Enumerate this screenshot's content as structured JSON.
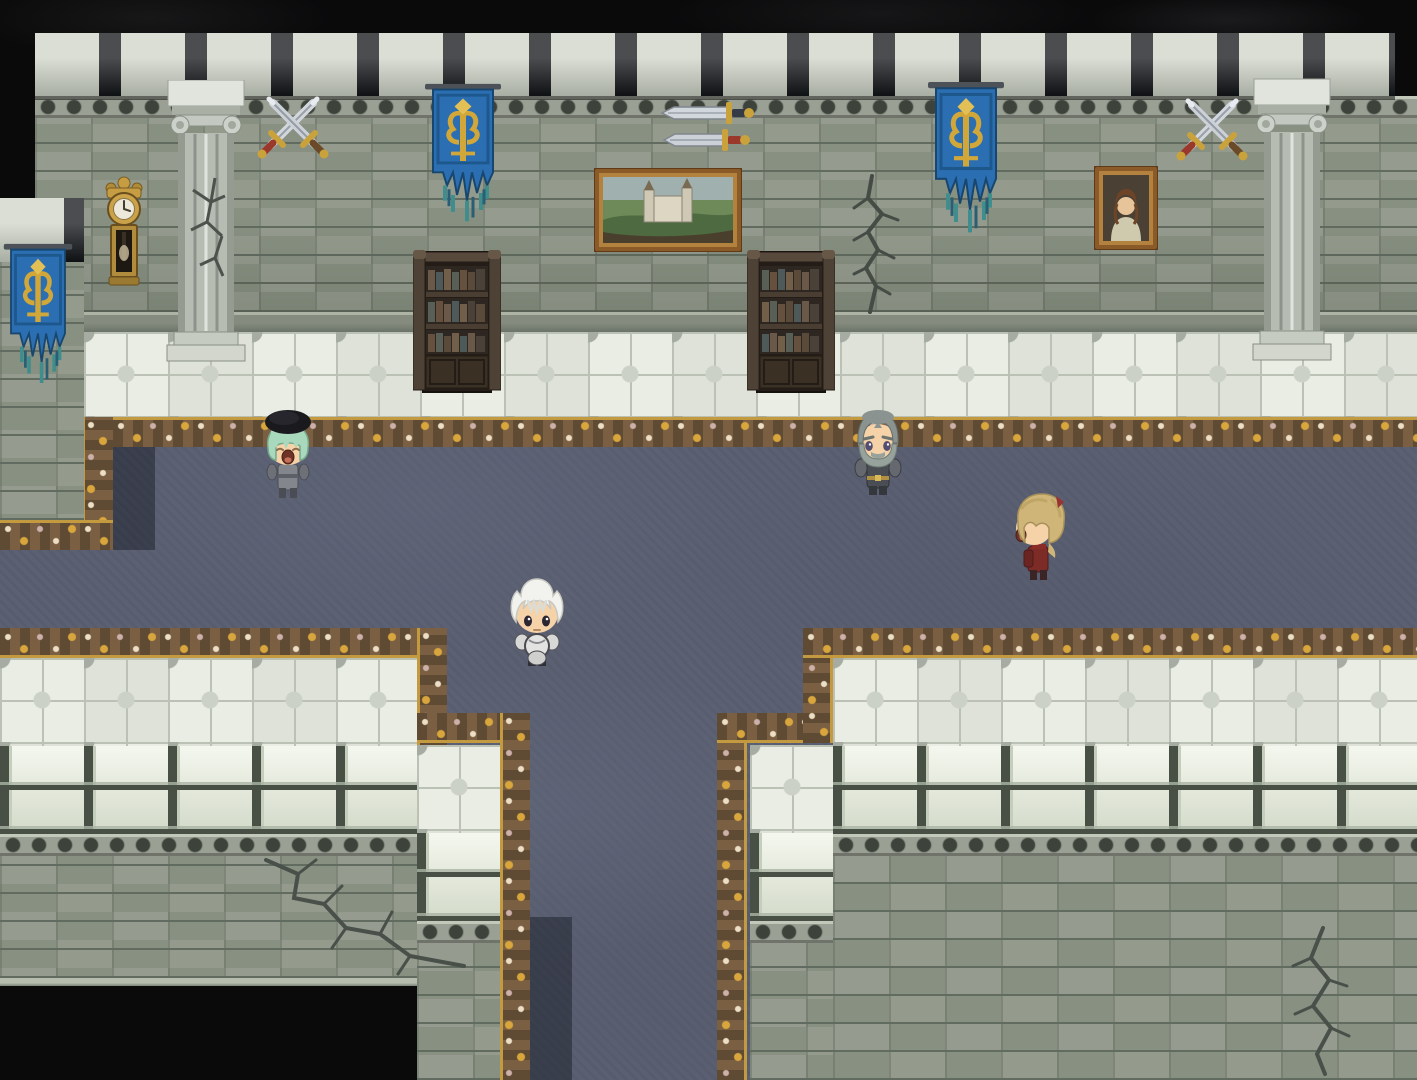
{
  "scene": {
    "title": "Castle Great Hall",
    "type": "rpg-top-down-map",
    "engine_style": "RPG Maker style pixel-art interior",
    "description": "Stone castle hall with battlemented walls, ionic columns, heraldic banners, mounted swords, paintings, a grandfather clock and bookshelves. A dark blue carpeted corridor with ornate gold borders runs horizontally and branches south between two lower wall blocks. Four chibi characters stand in the hall.",
    "visible_text": "none"
  },
  "palette": {
    "void": "#0a0a0b",
    "wall_brick": "#8e948a",
    "wall_mortar": "#626b60",
    "merlon_light": "#ced4c7",
    "cap_block": "#d8dfd0",
    "cap_gap": "#485046",
    "tile_floor": "#e4e7de",
    "tile_accent": "#a6aca2",
    "carpet": "#5b6173",
    "border_base": "#4a4134",
    "border_gold": "#d8a63c",
    "border_cream": "#ecdfc6",
    "banner_blue": "#2b6fb2",
    "banner_gold": "#d2a739",
    "banner_fringe_teal": "#3f8d8d",
    "wood_dark": "#3a3024",
    "clock_gold": "#c69d42",
    "sword_steel": "#d2d7dd",
    "sword_guard_gold": "#caa23c",
    "sword_grip_red": "#9a382c",
    "frame_brown": "#8a5a28"
  },
  "decorations": [
    {
      "id": "grandfather-clock",
      "label": "Gold grandfather wall clock",
      "pos": {
        "x": 97,
        "y": 175,
        "w": 54,
        "h": 118
      }
    },
    {
      "id": "column-cracked",
      "label": "Cracked ionic column",
      "pos": {
        "x": 165,
        "y": 80,
        "w": 82,
        "h": 287
      }
    },
    {
      "id": "column-intact",
      "label": "Ionic column",
      "pos": {
        "x": 1251,
        "y": 78,
        "w": 82,
        "h": 289
      }
    },
    {
      "id": "crossed-swords-left",
      "label": "Crossed swords wall mount",
      "pos": {
        "x": 255,
        "y": 93,
        "w": 76,
        "h": 70
      }
    },
    {
      "id": "crossed-swords-right",
      "label": "Crossed swords wall mount",
      "pos": {
        "x": 1174,
        "y": 95,
        "w": 76,
        "h": 70
      }
    },
    {
      "id": "mounted-swords-pair",
      "label": "Two horizontal display swords",
      "pos": {
        "x": 658,
        "y": 98,
        "w": 100,
        "h": 58
      }
    },
    {
      "id": "banner-buttress",
      "label": "Blue heraldic banner on buttress",
      "pos": {
        "x": 2,
        "y": 242,
        "w": 72,
        "h": 162
      }
    },
    {
      "id": "banner-left",
      "label": "Blue heraldic banner",
      "pos": {
        "x": 423,
        "y": 82,
        "w": 80,
        "h": 160
      }
    },
    {
      "id": "banner-right",
      "label": "Blue heraldic banner",
      "pos": {
        "x": 926,
        "y": 80,
        "w": 80,
        "h": 175
      }
    },
    {
      "id": "painting-landscape",
      "label": "Framed landscape painting of a castle",
      "pos": {
        "x": 594,
        "y": 168,
        "w": 148,
        "h": 84
      }
    },
    {
      "id": "painting-portrait",
      "label": "Framed portrait of a lady",
      "pos": {
        "x": 1094,
        "y": 166,
        "w": 64,
        "h": 84
      }
    },
    {
      "id": "bookshelf-left",
      "label": "Dark wooden bookshelf",
      "pos": {
        "x": 413,
        "y": 246,
        "w": 88,
        "h": 152
      }
    },
    {
      "id": "bookshelf-right",
      "label": "Dark wooden bookshelf",
      "pos": {
        "x": 747,
        "y": 246,
        "w": 88,
        "h": 152
      }
    },
    {
      "id": "wall-crack-upper",
      "label": "Crack in upper wall",
      "pos": {
        "x": 842,
        "y": 170,
        "w": 76,
        "h": 146
      }
    },
    {
      "id": "wall-crack-lower-left",
      "label": "Crack in lower-left wall",
      "pos": {
        "x": 258,
        "y": 842,
        "w": 215,
        "h": 140
      }
    },
    {
      "id": "wall-crack-lower-right",
      "label": "Crack in lower-right wall",
      "pos": {
        "x": 1253,
        "y": 922,
        "w": 135,
        "h": 155
      }
    }
  ],
  "characters": [
    {
      "id": "bard-npc",
      "label": "NPC with black beret and green hair, mouth open",
      "facing": "down",
      "hat": "#1a1a1e",
      "hair": "#a9d9bd",
      "outfit": "#83878d",
      "skin": "#f6d2a8",
      "pos": {
        "x": 255,
        "y": 402,
        "w": 66,
        "h": 102
      }
    },
    {
      "id": "hero",
      "label": "White-haired hero in white-and-dark armor",
      "facing": "down",
      "hair": "#f2f2ef",
      "outfit": "#dcdcda",
      "skin": "#f6d2a8",
      "pos": {
        "x": 504,
        "y": 570,
        "w": 66,
        "h": 102
      }
    },
    {
      "id": "old-knight-npc",
      "label": "Gray-haired bearded knight in dark armor",
      "facing": "down",
      "hair": "#8a938f",
      "beard": "#98a29c",
      "outfit": "#4a4d53",
      "skin": "#f6d2a8",
      "pos": {
        "x": 845,
        "y": 398,
        "w": 66,
        "h": 102
      }
    },
    {
      "id": "noble-npc",
      "label": "Blond noble in crimson coat",
      "facing": "left",
      "hair": "#cfb678",
      "outfit": "#7d2b27",
      "skin": "#f6d2a8",
      "pos": {
        "x": 1004,
        "y": 482,
        "w": 66,
        "h": 104
      }
    }
  ]
}
